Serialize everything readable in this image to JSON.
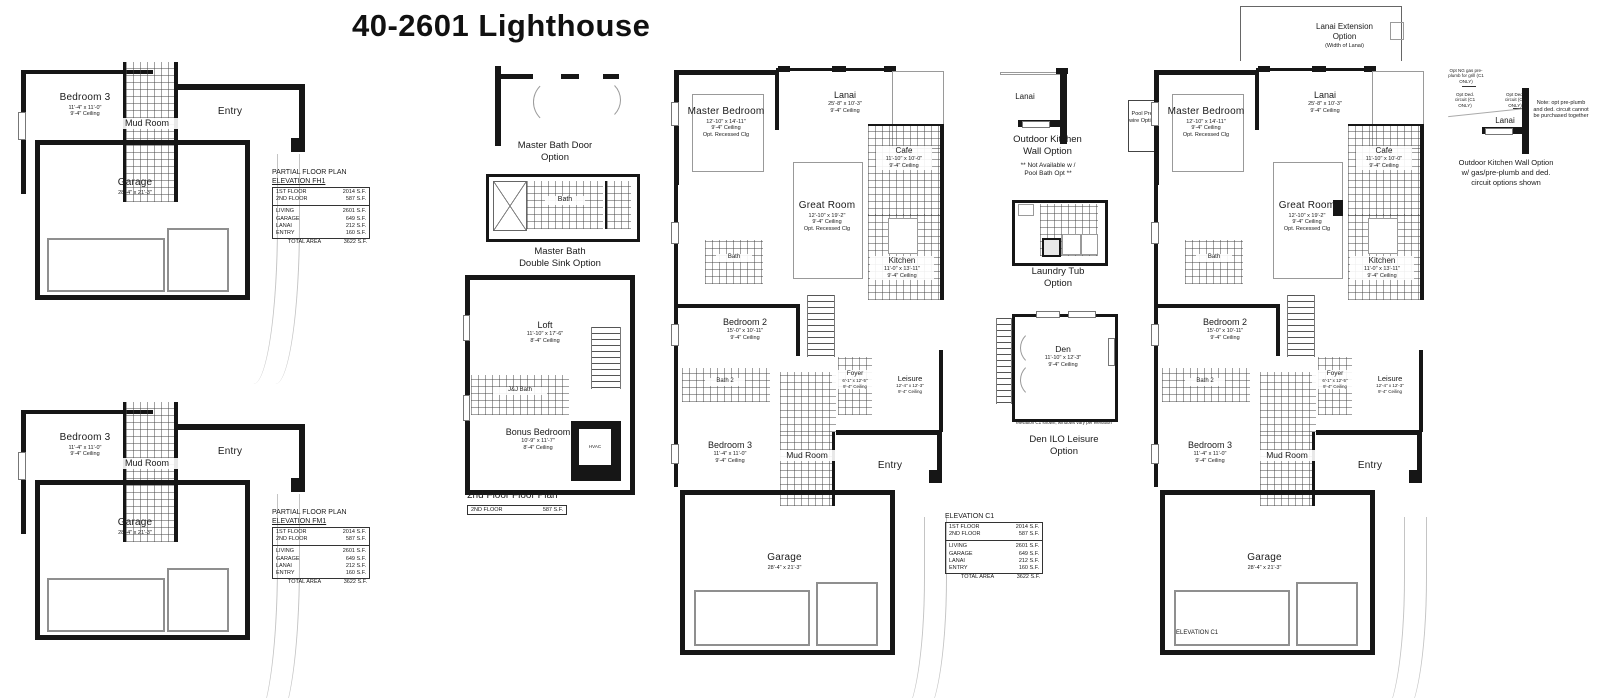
{
  "title": "40-2601 Lighthouse",
  "area_table": {
    "partial_heading": "PARTIAL FLOOR PLAN",
    "elevation_fh1": "ELEVATION FH1",
    "elevation_fm1": "ELEVATION FM1",
    "elevation_c1": "ELEVATION C1",
    "rows": [
      {
        "label": "1ST FLOOR",
        "value": "2014 S.F."
      },
      {
        "label": "2ND FLOOR",
        "value": "587 S.F."
      },
      {
        "label": "LIVING",
        "value": "2601 S.F."
      },
      {
        "label": "GARAGE",
        "value": "649 S.F."
      },
      {
        "label": "LANAI",
        "value": "212 S.F."
      },
      {
        "label": "ENTRY",
        "value": "160 S.F."
      }
    ],
    "total_label": "TOTAL AREA",
    "total_value": "3622 S.F."
  },
  "rooms": {
    "master_bedroom": {
      "name": "Master Bedroom",
      "dims": "12'-10\" x 14'-11\"",
      "ceiling": "9'-4\" Ceiling",
      "extra": "Opt. Recessed Clg"
    },
    "lanai": {
      "name": "Lanai",
      "dims": "25'-8\" x 10'-3\"",
      "ceiling": "9'-4\" Ceiling"
    },
    "great_room": {
      "name": "Great Room",
      "dims": "12'-10\" x 19'-2\"",
      "ceiling": "9'-4\" Ceiling",
      "extra": "Opt. Recessed Clg"
    },
    "cafe": {
      "name": "Cafe",
      "dims": "11'-10\" x 10'-0\"",
      "ceiling": "9'-4\" Ceiling"
    },
    "kitchen": {
      "name": "Kitchen",
      "dims": "11'-0\" x 13'-11\"",
      "ceiling": "9'-4\" Ceiling"
    },
    "bedroom2": {
      "name": "Bedroom 2",
      "dims": "15'-0\" x 10'-11\"",
      "ceiling": "9'-4\" Ceiling"
    },
    "bedroom3": {
      "name": "Bedroom 3",
      "dims": "11'-4\" x 11'-0\"",
      "ceiling": "9'-4\" Ceiling"
    },
    "foyer": {
      "name": "Foyer",
      "dims": "6'-1\" x 12'-5\"",
      "ceiling": "9'-4\" Ceiling"
    },
    "leisure": {
      "name": "Leisure",
      "dims": "12'-4\" x 12'-3\"",
      "ceiling": "9'-4\" Ceiling"
    },
    "garage": {
      "name": "Garage",
      "dims": "28'-4\" x 21'-3\""
    },
    "bath": {
      "name": "Bath"
    },
    "bath2": {
      "name": "Bath 2"
    },
    "mud_room": {
      "name": "Mud Room"
    },
    "entry": {
      "name": "Entry"
    },
    "loft": {
      "name": "Loft",
      "dims": "11'-10\" x 17'-6\"",
      "ceiling": "8'-4\" Ceiling"
    },
    "bonus_bedroom": {
      "name": "Bonus Bedroom",
      "dims": "10'-9\" x 11'-7\"",
      "ceiling": "8'-4\" Ceiling"
    },
    "jj_bath": {
      "name": "J&J Bath"
    },
    "den": {
      "name": "Den",
      "dims": "11'-10\" x 12'-3\"",
      "ceiling": "9'-4\" Ceiling"
    },
    "hvac": {
      "name": "HVAC"
    }
  },
  "second_floor": {
    "caption": "2nd Floor Floor Plan",
    "row_label": "2ND FLOOR",
    "row_value": "587 S.F."
  },
  "options": {
    "master_bath_door": {
      "line1": "Master Bath Door",
      "line2": "Option"
    },
    "master_bath_sink": {
      "line1": "Master Bath",
      "line2": "Double Sink Option"
    },
    "outdoor_kitchen": {
      "lanai": "Lanai",
      "line1": "Outdoor Kitchen",
      "line2": "Wall Option",
      "note1": "** Not Available w /",
      "note2": "Pool Bath Opt **"
    },
    "laundry": {
      "line1": "Laundry Tub",
      "line2": "Option"
    },
    "den": {
      "note": "elevation C1 shown, windows vary per elevation",
      "line1": "Den ILO Leisure",
      "line2": "Option"
    },
    "pool": {
      "label": "Pool Pre-wire Option"
    },
    "lanai_ext": {
      "line1": "Lanai Extension",
      "line2": "Option",
      "sub": "(Width of Lanai)"
    },
    "outdoor_kitchen_gas": {
      "lanai": "Lanai",
      "small1": "Opt NG gas pre-plumb for grill (C1 ONLY)",
      "small2": "Opt Ded. circuit (C1 ONLY)",
      "small3": "Opt Ded. circuit (C1 ONLY)",
      "note": "Note: opt pre-plumb and ded. circuit cannot be purchased together",
      "caption": "Outdoor Kitchen Wall Option w/ gas/pre-plumb and ded. circuit options shown"
    },
    "elevation_c1_plan_label": "ELEVATION C1"
  }
}
